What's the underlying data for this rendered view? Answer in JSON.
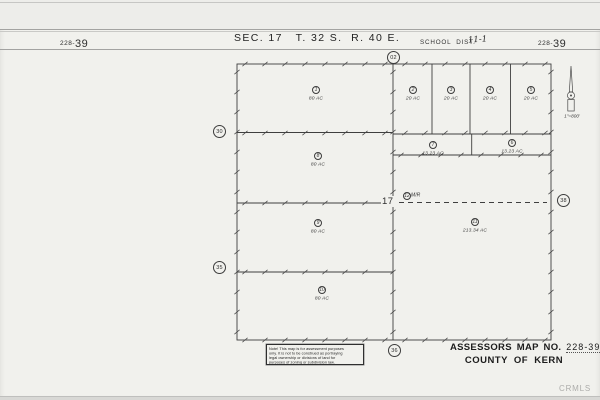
{
  "header": {
    "map_no_small": "228-",
    "map_no_big": "39",
    "section_title": "SEC. 17   T. 32 S.  R. 40 E.",
    "school_dist_label": "SCHOOL  DIST.",
    "school_dist_value": "11-1"
  },
  "map": {
    "section_number": "17",
    "scale_note": "1\"=800'",
    "adjacent_refs": {
      "top": "02",
      "left_upper": "30",
      "left_lower": "35",
      "right": "38",
      "bottom": "36"
    },
    "parcels": [
      {
        "num": "1",
        "acreage": "80 AC"
      },
      {
        "num": "2",
        "acreage": "20 AC"
      },
      {
        "num": "3",
        "acreage": "20 AC"
      },
      {
        "num": "4",
        "acreage": "20 AC"
      },
      {
        "num": "5",
        "acreage": "20 AC"
      },
      {
        "num": "6",
        "acreage": "13.23 AC"
      },
      {
        "num": "7",
        "acreage": "13.23 AC"
      },
      {
        "num": "8",
        "acreage": "80 AC"
      },
      {
        "num": "9",
        "acreage": "80 AC"
      },
      {
        "num": "10",
        "acreage": "80 AC"
      },
      {
        "num": "11",
        "acreage": "213.34 AC"
      },
      {
        "num": "12",
        "acreage": "M/R"
      }
    ]
  },
  "note_box": {
    "lines": [
      "Note! This map is for assessment purposes",
      "only. It is not to be construed as portraying",
      "legal ownership or divisions of land for",
      "purposes of zoning or subdivision law."
    ]
  },
  "title_block": {
    "assessors_label": "ASSESSORS MAP NO.",
    "map_no": "228-39",
    "county_label": "COUNTY OF KERN"
  },
  "watermark": "CRMLS"
}
